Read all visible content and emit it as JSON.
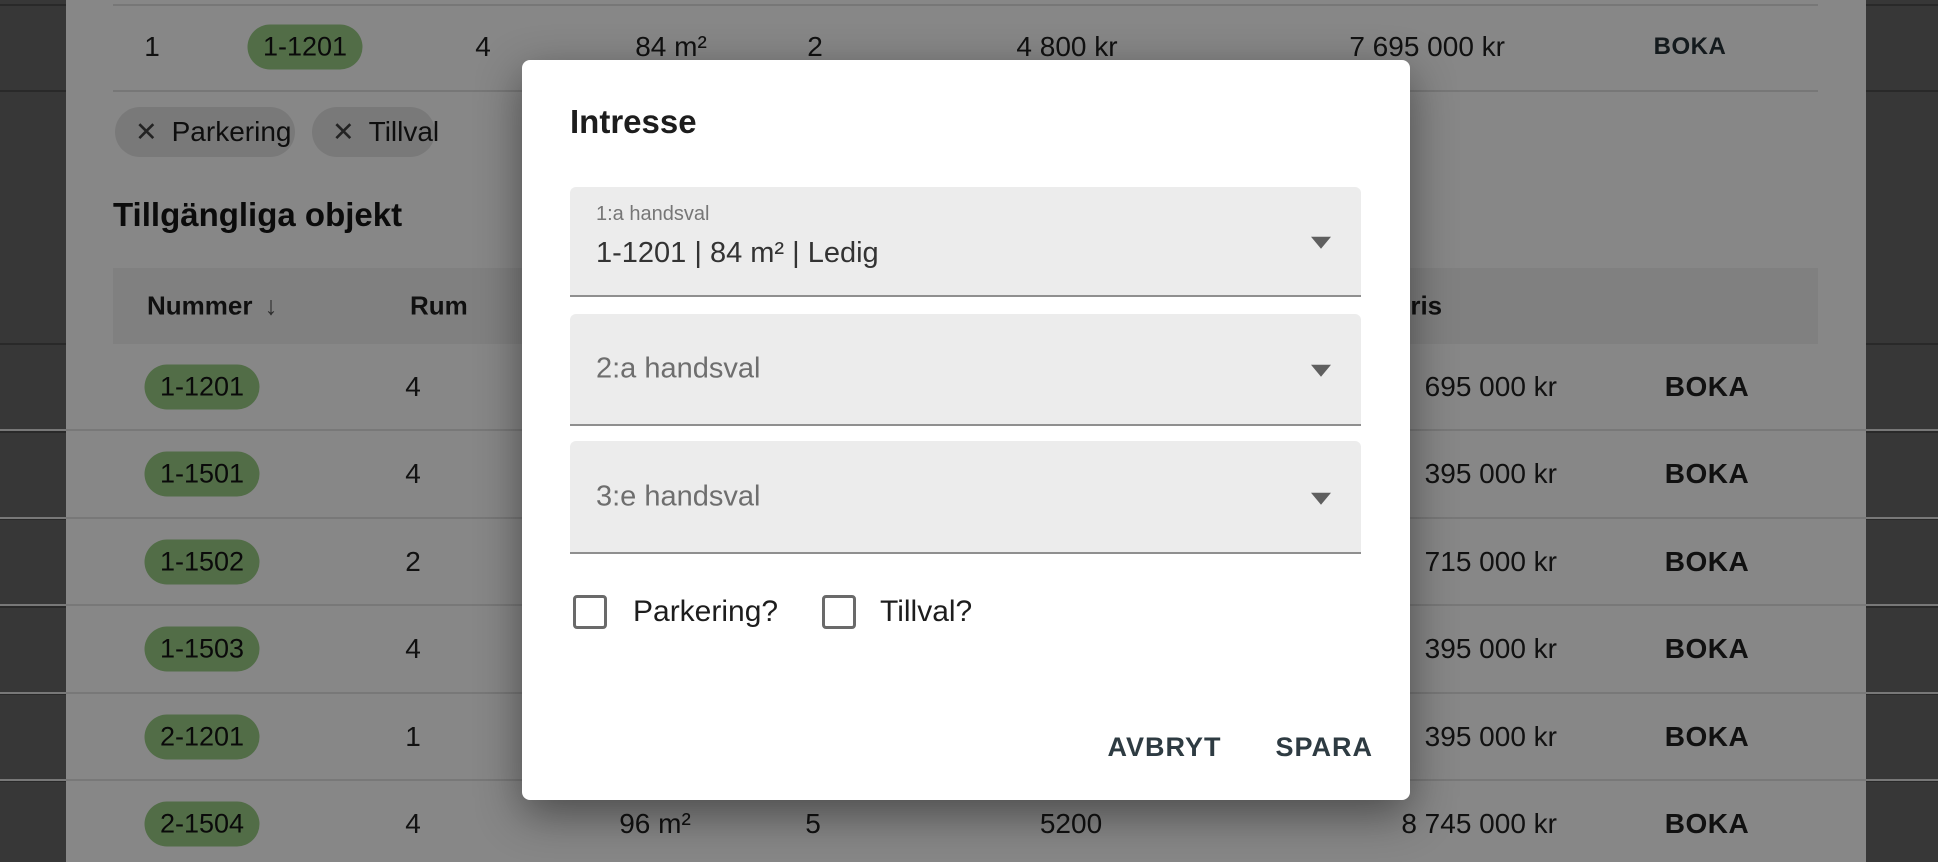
{
  "colors": {
    "badge_green": "#9bce87",
    "action_text": "#2e3b42",
    "boka_text": "#263238"
  },
  "icons": {
    "close": "✕",
    "sort_desc": "↓",
    "dropdown": "▼"
  },
  "top_row": {
    "queue": "1",
    "number": "1-1201",
    "rum": "4",
    "storlek": "84 m²",
    "vaning": "2",
    "avgift": "4 800 kr",
    "pris": "7 695 000 kr",
    "boka": "BOKA"
  },
  "filter_chips": [
    {
      "label": "Parkering"
    },
    {
      "label": "Tillval"
    }
  ],
  "section_title": "Tillgängliga objekt",
  "table": {
    "headers": {
      "nummer": "Nummer",
      "rum": "Rum",
      "pris": "Pris"
    },
    "rows": [
      {
        "number": "1-1201",
        "rum": "4",
        "pris_visible": "695 000 kr",
        "boka": "BOKA"
      },
      {
        "number": "1-1501",
        "rum": "4",
        "pris_visible": "395 000 kr",
        "boka": "BOKA"
      },
      {
        "number": "1-1502",
        "rum": "2",
        "pris_visible": "715 000 kr",
        "boka": "BOKA"
      },
      {
        "number": "1-1503",
        "rum": "4",
        "pris_visible": "395 000 kr",
        "boka": "BOKA"
      },
      {
        "number": "2-1201",
        "rum": "1",
        "pris_visible": "395 000 kr",
        "boka": "BOKA"
      },
      {
        "number": "2-1504",
        "rum": "4",
        "storlek": "96 m²",
        "vaning": "5",
        "avgift": "5200",
        "pris_visible": "8 745 000 kr",
        "boka": "BOKA"
      }
    ]
  },
  "dialog": {
    "title": "Intresse",
    "fields": [
      {
        "label": "1:a handsval",
        "value": "1-1201 | 84 m² | Ledig"
      },
      {
        "label": "2:a handsval",
        "value": ""
      },
      {
        "label": "3:e handsval",
        "value": ""
      }
    ],
    "checkboxes": [
      {
        "label": "Parkering?",
        "checked": false
      },
      {
        "label": "Tillval?",
        "checked": false
      }
    ],
    "buttons": {
      "cancel": "AVBRYT",
      "save": "SPARA"
    }
  }
}
